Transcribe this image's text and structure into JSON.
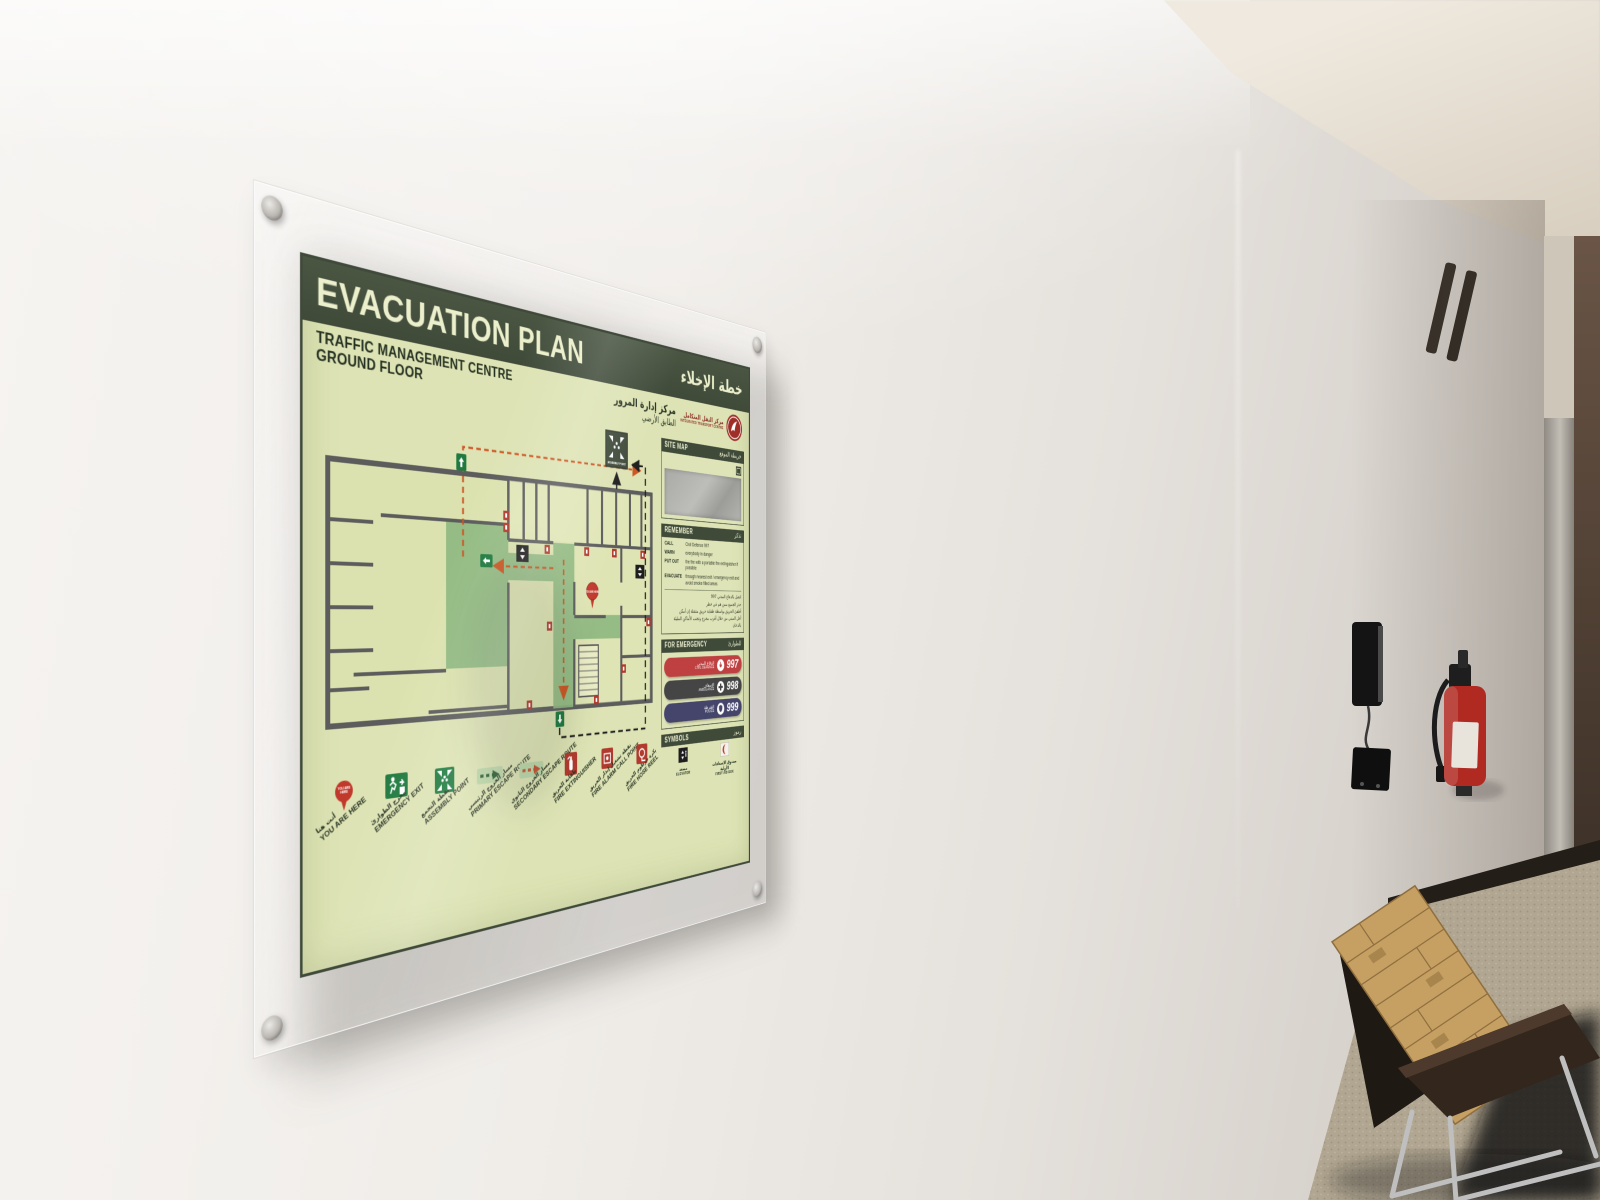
{
  "colors": {
    "header_green": "#47523f",
    "panel_green": "#dde3b4",
    "title_cream": "#ecefcb",
    "plan_floor": "#dce2af",
    "corridor_green": "#8fb981",
    "route_primary": "#cc5522",
    "route_secondary": "#1d1d1d",
    "civil_defence_red": "#bf4040",
    "ambulance_gray": "#454545",
    "police_navy": "#45456b",
    "emblem_red": "#9e2f28"
  },
  "sign": {
    "title": "EVACUATION PLAN",
    "title_ar": "خطة الإخلاء",
    "subtitle": {
      "line1": "TRAFFIC MANAGEMENT CENTRE",
      "line2": "GROUND FLOOR",
      "ar1": "مركز إدارة المرور",
      "ar2": "الطابق الأرضي"
    },
    "logo": {
      "name_ar": "مركز النقل المتكامل",
      "name_en": "INTEGRATED TRANSPORT CENTRE"
    },
    "plan": {
      "assembly_label": "ASSEMBLY POINT",
      "you_are_here_label": "YOU ARE HERE"
    },
    "sections": {
      "site_map": {
        "label": "SITE MAP",
        "label_ar": "خريطة الموقع"
      },
      "remember": {
        "label": "REMEMBER",
        "label_ar": "تذكر",
        "items": [
          {
            "key": "CALL",
            "text": "Civil Defence 997"
          },
          {
            "key": "WARN",
            "text": "everybody in danger"
          },
          {
            "key": "PUT OUT",
            "text": "the fire with a portable fire extinguisher if possible"
          },
          {
            "key": "EVACUATE",
            "text": "through nearest exit / emergency exit and avoid smoke filled areas"
          }
        ],
        "items_ar": [
          "اتصل بالدفاع المدني 997",
          "حذر الجميع ممن هم في خطر",
          "أطفئ الحريق بواسطة طفاية حريق متنقلة إن أمكن",
          "أخل المبنى من خلال أقرب مخرج وتجنب الأماكن المليئة بالدخان"
        ]
      },
      "for_emergency": {
        "label": "FOR EMERGENCY",
        "label_ar": "للطوارئ",
        "numbers": [
          {
            "name": "CIVIL DEFENCE",
            "name_ar": "الدفاع المدني",
            "number": "997",
            "color": "#bf4040"
          },
          {
            "name": "AMBULANCE",
            "name_ar": "الإسعاف",
            "number": "998",
            "color": "#454545"
          },
          {
            "name": "POLICE",
            "name_ar": "الشرطة",
            "number": "999",
            "color": "#45456b"
          }
        ]
      },
      "symbols": {
        "label": "SYMBOLS",
        "label_ar": "رموز",
        "items": [
          {
            "name": "ELEVATOR",
            "name_ar": "مصعد"
          },
          {
            "name": "FIRST AID BOX",
            "name_ar": "صندوق الإسعافات الأولية"
          }
        ]
      }
    },
    "legend": [
      {
        "en": "YOU ARE HERE",
        "ar": "أنت هنا"
      },
      {
        "en": "EMERGENCY EXIT",
        "ar": "مخرج الطوارئ"
      },
      {
        "en": "ASSEMBLY POINT",
        "ar": "نقطة التجمع"
      },
      {
        "en": "PRIMARY ESCAPE ROUTE",
        "ar": "مسار الخروج الرئيسي"
      },
      {
        "en": "SECONDARY ESCAPE ROUTE",
        "ar": "مسار الخروج الثانوي"
      },
      {
        "en": "FIRE EXTINGUISHER",
        "ar": "طفاية الحريق"
      },
      {
        "en": "FIRE ALARM CALL POINT",
        "ar": "نقطة تشغيل إنذار الحريق"
      },
      {
        "en": "FIRE HOSE REEL",
        "ar": "بكرة خرطوم الحريق"
      }
    ]
  }
}
